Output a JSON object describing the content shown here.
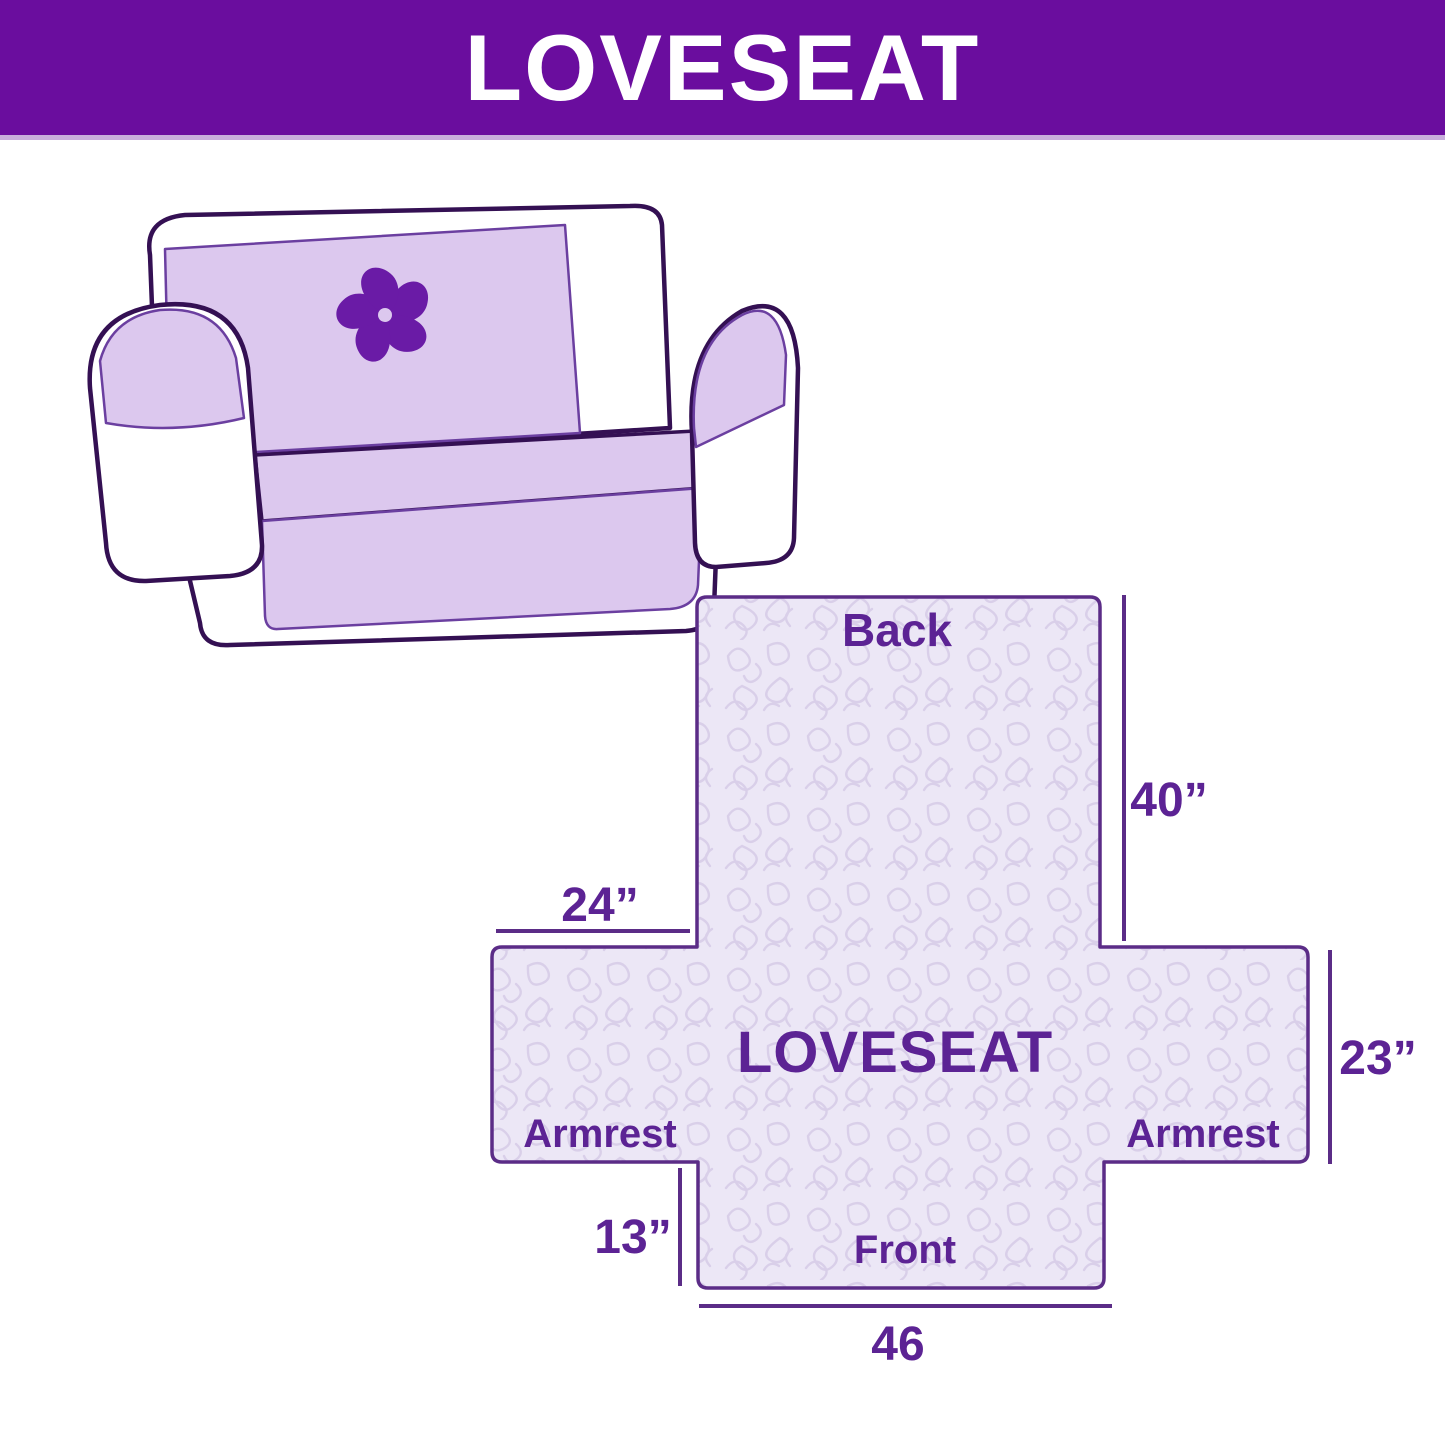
{
  "header": {
    "title": "LOVESEAT",
    "colors": {
      "background": "#6A0D9E",
      "text": "#FFFFFF",
      "bottom_strip": "#C8ADDC"
    }
  },
  "illustration": {
    "description": "Loveseat sofa wearing a quilted protective cover",
    "logo_icon": "pinwheel-icon",
    "colors": {
      "outline": "#341053",
      "body": "#FFFFFF",
      "cover": "#DCC8EE",
      "cover_edge": "#6B3FA0",
      "logo": "#6A1BA6"
    }
  },
  "diagram": {
    "product_label": "LOVESEAT",
    "sections": {
      "back": "Back",
      "front": "Front",
      "armrest_left": "Armrest",
      "armrest_right": "Armrest"
    },
    "dimensions": {
      "back_height": "40”",
      "back_top_width": "24”",
      "armrest_height": "23”",
      "front_drop": "13”",
      "front_width": "46"
    },
    "colors": {
      "fill": "#ECE7F6",
      "pattern_line": "#D9CFE9",
      "outline": "#5B2C87",
      "text": "#5C2394"
    }
  }
}
